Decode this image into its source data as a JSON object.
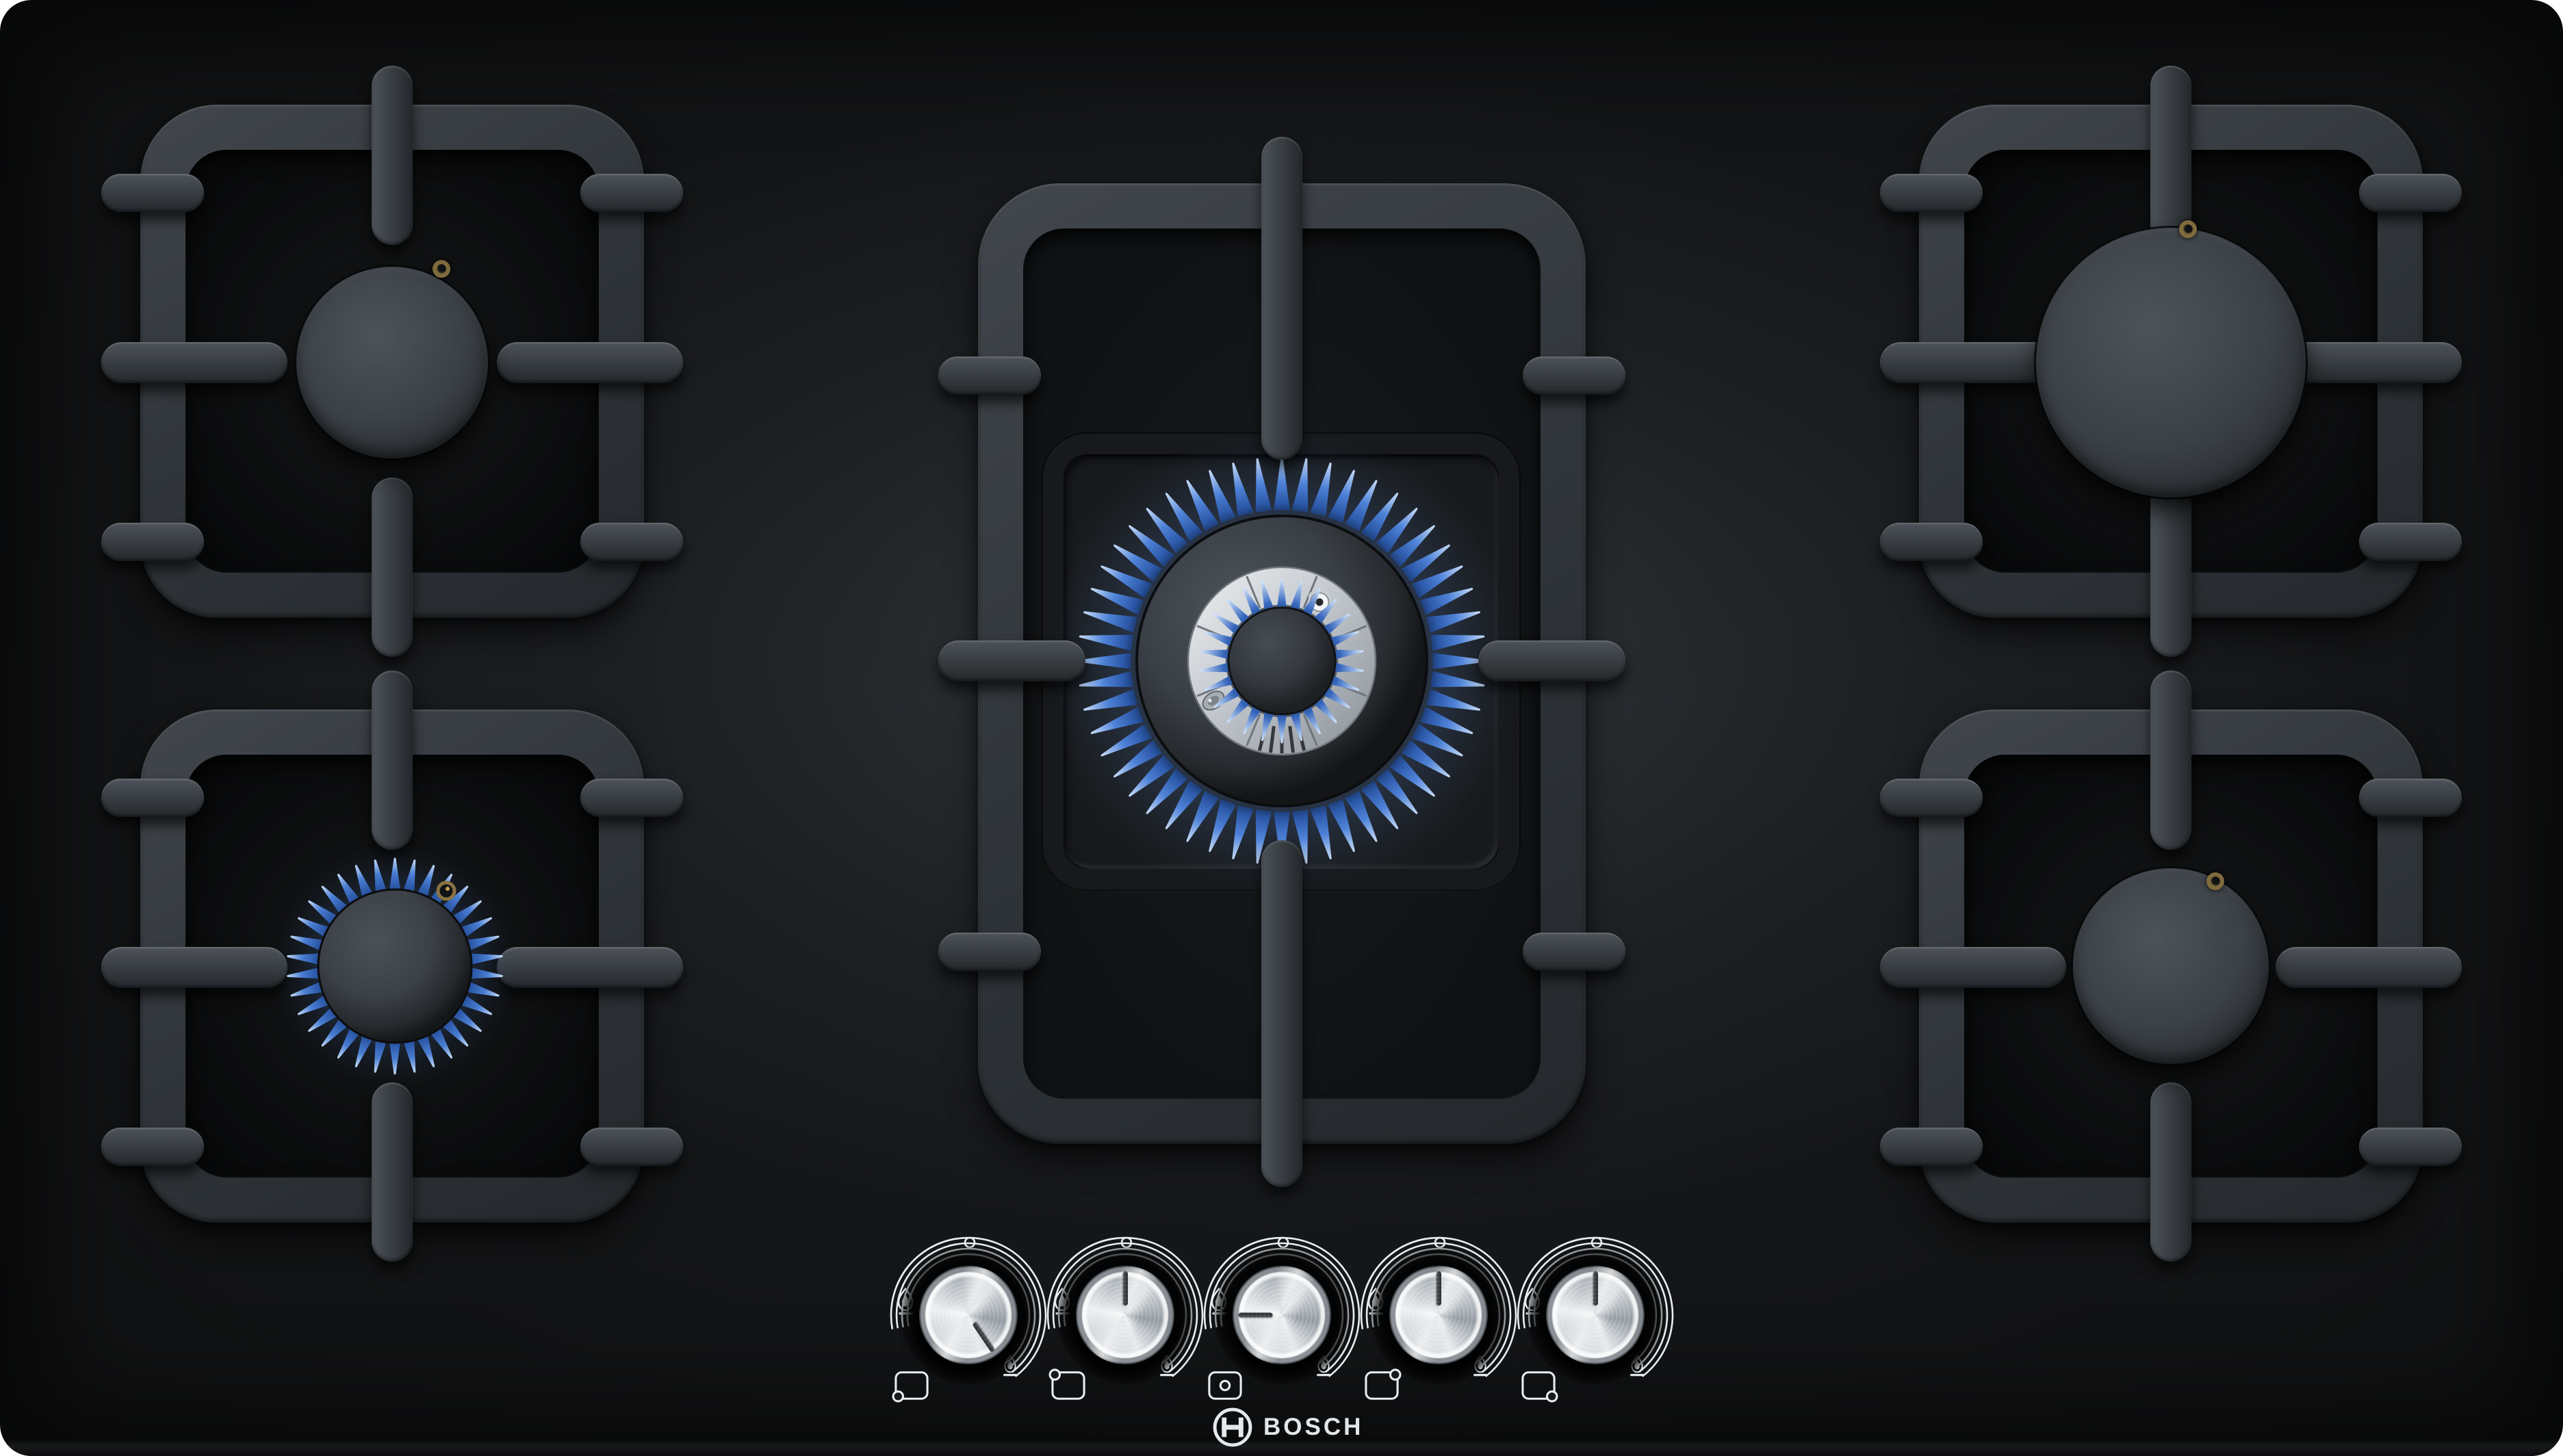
{
  "brand": {
    "logo_text": "BOSCH",
    "logo_symbol": "bosch-armature-icon"
  },
  "appliance": {
    "type": "gas hob",
    "surface": "black tempered glass",
    "burner_count": 5,
    "control_count": 5
  },
  "burners": [
    {
      "name": "back-left",
      "size": "standard",
      "state": "off",
      "grate": "square-cast-iron"
    },
    {
      "name": "front-left",
      "size": "economy",
      "state": "lit-low",
      "grate": "square-cast-iron"
    },
    {
      "name": "center-wok",
      "size": "dual-ring-wok",
      "state": "lit-high",
      "grate": "double-frame-cast-iron"
    },
    {
      "name": "back-right",
      "size": "high-power",
      "state": "off",
      "grate": "square-cast-iron"
    },
    {
      "name": "front-right",
      "size": "standard",
      "state": "off",
      "grate": "square-cast-iron"
    }
  ],
  "knobs": [
    {
      "controls": "front-left",
      "dot_position": "bottom-left",
      "setting": "low",
      "angle_deg": 146
    },
    {
      "controls": "back-left",
      "dot_position": "top-left",
      "setting": "off",
      "angle_deg": 0
    },
    {
      "controls": "center-wok",
      "dot_position": "center",
      "setting": "high",
      "angle_deg": 270
    },
    {
      "controls": "back-right",
      "dot_position": "top-right",
      "setting": "off",
      "angle_deg": 0
    },
    {
      "controls": "front-right",
      "dot_position": "bottom-right",
      "setting": "off",
      "angle_deg": 0
    }
  ],
  "knob_markings": {
    "off_symbol": "small-circle-top",
    "max_symbol": "large-flame-left",
    "min_symbol": "small-flame-bottom-right"
  },
  "colors": {
    "glass_black": "#0b0c0d",
    "grate_metal": "#3a4046",
    "burner_cap": "#3b4147",
    "flame_base": "#16325f",
    "flame_mid": "#3f74cc",
    "flame_tip": "#c3d9f7",
    "silver_ring": "#c9ced3",
    "knob_chrome": "#d7dbde",
    "marking_white": "#eaedef",
    "igniter_gold": "#96794a",
    "logo_white": "#e3e6e8"
  },
  "flames": {
    "wok_outer": {
      "count": 52,
      "r_base": 222,
      "r_tip": 297,
      "half_deg": 2.6,
      "grad": "gradOuter"
    },
    "wok_inner": {
      "count": 26,
      "r_base": 72,
      "r_tip": 119,
      "half_deg": 5.0,
      "grad": "gradInner"
    },
    "front_left": {
      "count": 34,
      "r_base": 104,
      "r_tip": 157,
      "half_deg": 4.2,
      "grad": "gradSmall"
    },
    "ring_segments": {
      "count": 8,
      "offset": 22.5,
      "r1": 84,
      "r2": 134
    },
    "ring_slots": {
      "angles": [
        166,
        173,
        180,
        187,
        194
      ],
      "r1": 96,
      "r2": 135
    }
  }
}
